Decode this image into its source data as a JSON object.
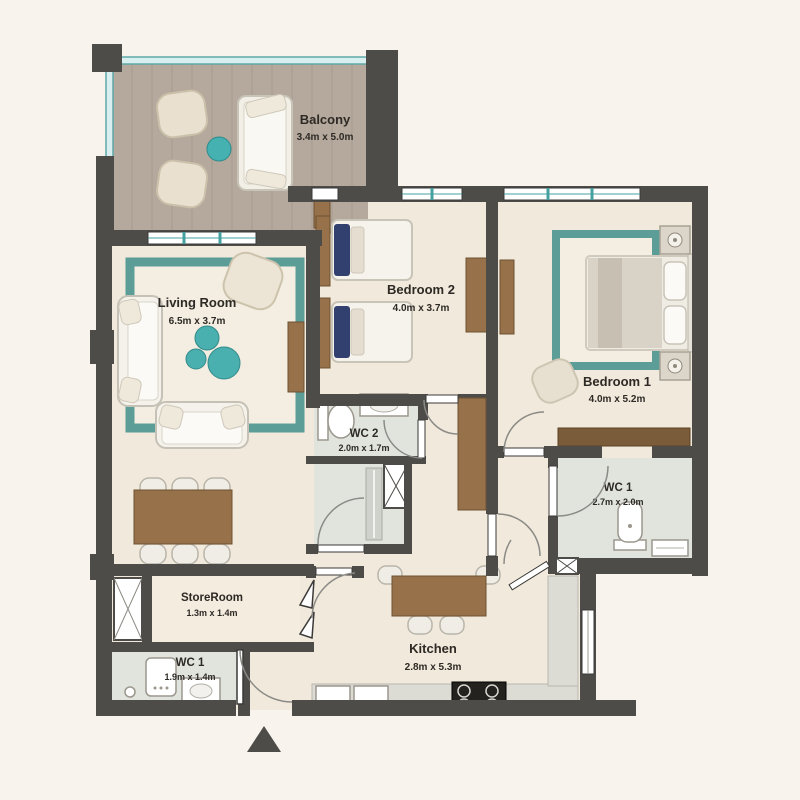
{
  "plan": {
    "type": "apartment-floor-plan",
    "entrance_marker": "up-triangle"
  },
  "palette": {
    "background": "#f8f4ed",
    "wall": "#4e4c49",
    "floor": "#f1e9db",
    "balcony_floor": "#b4a99c",
    "wet_room_floor": "#e0e4dd",
    "rug_teal": "#5c9d97",
    "accent_teal": "#45b1b1",
    "wood": "#96714a",
    "counter": "#dddcd4",
    "furniture_cream": "#ece4d4",
    "pillow_navy": "#31406e",
    "label_text": "#2d2925"
  },
  "rooms": [
    {
      "name": "Balcony",
      "dims": "3.4m x 5.0m",
      "furniture": [
        "armchair",
        "armchair",
        "round-table",
        "sofa"
      ]
    },
    {
      "name": "Living Room",
      "dims": "6.5m x 3.7m",
      "furniture": [
        "rug",
        "sofa",
        "sofa",
        "armchair",
        "coffee-tables",
        "tv-cabinet",
        "dining-table",
        "chairs"
      ]
    },
    {
      "name": "Bedroom 2",
      "dims": "4.0m x 3.7m",
      "furniture": [
        "single-bed",
        "single-bed",
        "headboard-panels",
        "wardrobe"
      ]
    },
    {
      "name": "Bedroom 1",
      "dims": "4.0m x 5.2m",
      "furniture": [
        "rug",
        "double-bed",
        "nightstand",
        "nightstand",
        "armchair",
        "wardrobe"
      ]
    },
    {
      "name": "WC 2",
      "dims": "2.0m x 1.7m",
      "furniture": [
        "toilet",
        "sink",
        "shower",
        "shaft"
      ]
    },
    {
      "name": "WC 1",
      "dims": "2.7m x 2.0m",
      "furniture": [
        "toilet",
        "sink",
        "wardrobe"
      ]
    },
    {
      "name": "StoreRoom",
      "dims": "1.3m x 1.4m",
      "furniture": [
        "closet",
        "bifold-doors"
      ]
    },
    {
      "name": "WC 1",
      "dims": "1.9m x 1.4m",
      "furniture": [
        "boiler",
        "sink"
      ]
    },
    {
      "name": "Kitchen",
      "dims": "2.8m x 5.3m",
      "furniture": [
        "dining-table",
        "chairs",
        "counter",
        "stove",
        "appliances"
      ]
    }
  ]
}
